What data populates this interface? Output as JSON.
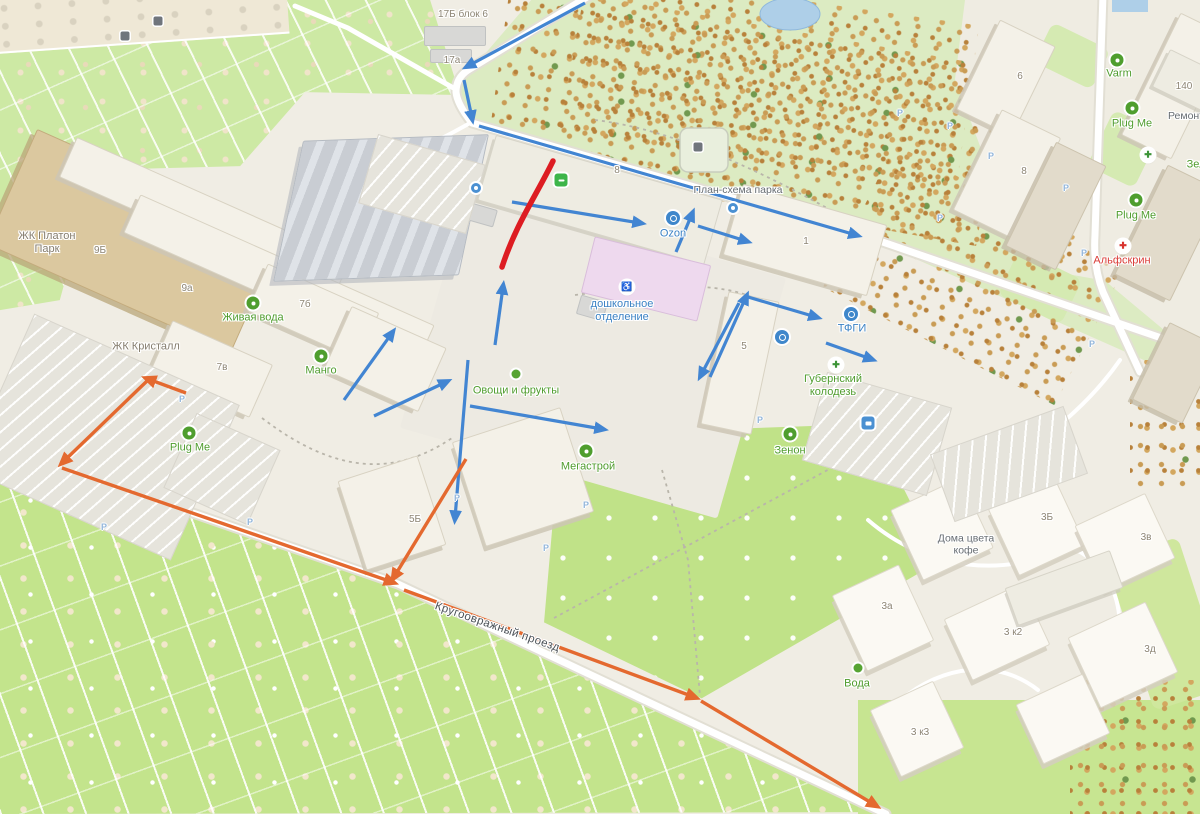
{
  "map": {
    "colors": {
      "route_blue": "#4285d2",
      "route_orange": "#e4692f",
      "closed_red": "#dd1c22",
      "road_casing": "#e2dfd4",
      "road_fill": "#ffffff"
    },
    "labels": [
      {
        "id": "zhk-platon-park",
        "text": "ЖК Платон\nПарк",
        "x": 47,
        "y": 243,
        "cls": "l-dist"
      },
      {
        "id": "zhk-kristall",
        "text": "ЖК Кристалл",
        "x": 146,
        "y": 347,
        "cls": "l-dist"
      },
      {
        "id": "num-9b",
        "text": "9Б",
        "x": 100,
        "y": 251,
        "cls": "l-num"
      },
      {
        "id": "num-9a",
        "text": "9а",
        "x": 187,
        "y": 289,
        "cls": "l-num"
      },
      {
        "id": "num-7b",
        "text": "7б",
        "x": 305,
        "y": 305,
        "cls": "l-num"
      },
      {
        "id": "num-7v",
        "text": "7в",
        "x": 222,
        "y": 368,
        "cls": "l-num"
      },
      {
        "id": "num-5b",
        "text": "5Б",
        "x": 415,
        "y": 520,
        "cls": "l-num"
      },
      {
        "id": "num-5",
        "text": "5",
        "x": 744,
        "y": 347,
        "cls": "l-num"
      },
      {
        "id": "num-1",
        "text": "1",
        "x": 806,
        "y": 242,
        "cls": "l-num"
      },
      {
        "id": "num-6",
        "text": "6",
        "x": 1020,
        "y": 77,
        "cls": "l-num"
      },
      {
        "id": "num-8",
        "text": "8",
        "x": 1024,
        "y": 172,
        "cls": "l-num"
      },
      {
        "id": "num-140",
        "text": "140",
        "x": 1184,
        "y": 87,
        "cls": "l-num"
      },
      {
        "id": "num-3b",
        "text": "3Б",
        "x": 1047,
        "y": 518,
        "cls": "l-num"
      },
      {
        "id": "num-3v",
        "text": "3в",
        "x": 1146,
        "y": 538,
        "cls": "l-num"
      },
      {
        "id": "num-3a",
        "text": "3а",
        "x": 887,
        "y": 607,
        "cls": "l-num"
      },
      {
        "id": "num-3k2",
        "text": "3 к2",
        "x": 1013,
        "y": 633,
        "cls": "l-num"
      },
      {
        "id": "num-3d",
        "text": "3д",
        "x": 1150,
        "y": 650,
        "cls": "l-num"
      },
      {
        "id": "num-3k3",
        "text": "3 к3",
        "x": 920,
        "y": 733,
        "cls": "l-num"
      },
      {
        "id": "num-17b-blok6",
        "text": "17Б блок 6",
        "x": 463,
        "y": 15,
        "cls": "l-num"
      },
      {
        "id": "num-17a",
        "text": "17а",
        "x": 452,
        "y": 61,
        "cls": "l-num"
      },
      {
        "id": "road-num-8",
        "text": "8",
        "x": 617,
        "y": 171,
        "cls": "l-num"
      },
      {
        "id": "poi-zhivaya-voda",
        "text": "Живая вода",
        "x": 253,
        "y": 318,
        "cls": "l-green"
      },
      {
        "id": "poi-mango",
        "text": "Манго",
        "x": 321,
        "y": 371,
        "cls": "l-green"
      },
      {
        "id": "poi-ovoshchi-frukty",
        "text": "Овощи и фрукты",
        "x": 516,
        "y": 391,
        "cls": "l-green"
      },
      {
        "id": "poi-megastroy",
        "text": "Мегастрой",
        "x": 588,
        "y": 467,
        "cls": "l-green"
      },
      {
        "id": "poi-plug-me-left",
        "text": "Plug Me",
        "x": 190,
        "y": 448,
        "cls": "l-green"
      },
      {
        "id": "poi-plug-me-right-upper",
        "text": "Plug Me",
        "x": 1132,
        "y": 124,
        "cls": "l-green"
      },
      {
        "id": "poi-plug-me-right-lower",
        "text": "Plug Me",
        "x": 1136,
        "y": 216,
        "cls": "l-green"
      },
      {
        "id": "poi-varm",
        "text": "Varm",
        "x": 1119,
        "y": 74,
        "cls": "l-green"
      },
      {
        "id": "poi-zenon",
        "text": "Зенон",
        "x": 790,
        "y": 451,
        "cls": "l-green"
      },
      {
        "id": "poi-voda",
        "text": "Вода",
        "x": 857,
        "y": 684,
        "cls": "l-green"
      },
      {
        "id": "poi-zel",
        "text": "Зел",
        "x": 1196,
        "y": 165,
        "cls": "l-green"
      },
      {
        "id": "poi-gubernsky-kolodez",
        "text": "Губернский\nколодезь",
        "x": 833,
        "y": 386,
        "cls": "l-green"
      },
      {
        "id": "poi-ozon",
        "text": "Ozon",
        "x": 673,
        "y": 234,
        "cls": "l-blue"
      },
      {
        "id": "poi-tfgi",
        "text": "ТФГИ",
        "x": 852,
        "y": 329,
        "cls": "l-blue"
      },
      {
        "id": "poi-doshkolnoe",
        "text": "дошкольное\nотделение",
        "x": 622,
        "y": 311,
        "cls": "l-blue"
      },
      {
        "id": "poi-plan-schema-parka",
        "text": "План-схема парка",
        "x": 738,
        "y": 190,
        "cls": "l-gray"
      },
      {
        "id": "poi-doma-tsveta-kofe",
        "text": "Дома цвета\nкофе",
        "x": 966,
        "y": 545,
        "cls": "l-gray"
      },
      {
        "id": "poi-remont",
        "text": "Ремонт",
        "x": 1186,
        "y": 116,
        "cls": "l-gray"
      },
      {
        "id": "poi-alfskrin",
        "text": "Альфскрин",
        "x": 1122,
        "y": 261,
        "cls": "l-red"
      },
      {
        "id": "street-krugoovrazhny",
        "text": "Кругоовражный проезд",
        "x": 497,
        "y": 628,
        "cls": "l-street",
        "rot": 19
      }
    ],
    "icons": [
      {
        "id": "pyaterochka-icon",
        "kind": "green-square",
        "x": 561,
        "y": 180
      },
      {
        "id": "zhivaya-voda-icon",
        "kind": "green-circle",
        "x": 253,
        "y": 303
      },
      {
        "id": "mango-icon",
        "kind": "green-circle",
        "x": 321,
        "y": 356
      },
      {
        "id": "ovoshchi-frukty-icon",
        "kind": "green-dot",
        "x": 516,
        "y": 374
      },
      {
        "id": "megastroy-icon",
        "kind": "green-circle",
        "x": 586,
        "y": 451
      },
      {
        "id": "plug-me-left-icon",
        "kind": "green-circle",
        "x": 189,
        "y": 433
      },
      {
        "id": "plug-me-right-upper-icon",
        "kind": "green-circle",
        "x": 1132,
        "y": 108
      },
      {
        "id": "plug-me-right-lower-icon",
        "kind": "green-circle",
        "x": 1136,
        "y": 200
      },
      {
        "id": "varm-icon",
        "kind": "green-circle",
        "x": 1117,
        "y": 60
      },
      {
        "id": "zenon-icon",
        "kind": "green-circle",
        "x": 790,
        "y": 434
      },
      {
        "id": "voda-icon",
        "kind": "green-dot",
        "x": 858,
        "y": 668
      },
      {
        "id": "gubernsky-kolodez-icon",
        "kind": "green-cross",
        "x": 836,
        "y": 365,
        "g": "✚"
      },
      {
        "id": "pharmacy-cross-icon",
        "kind": "green-cross",
        "x": 1148,
        "y": 155,
        "g": "✚"
      },
      {
        "id": "ozon-icon",
        "kind": "blue-circle",
        "x": 673,
        "y": 218
      },
      {
        "id": "tfgi-icon",
        "kind": "blue-circle",
        "x": 851,
        "y": 314
      },
      {
        "id": "info-icon",
        "kind": "blue-circle",
        "x": 782,
        "y": 337
      },
      {
        "id": "kiosk-icon",
        "kind": "blue-square",
        "x": 868,
        "y": 423
      },
      {
        "id": "alfskrin-icon",
        "kind": "red-circle",
        "x": 1123,
        "y": 246,
        "g": "✚"
      },
      {
        "id": "wheelchair-icon",
        "kind": "wheel",
        "x": 627,
        "y": 287,
        "g": "♿"
      },
      {
        "id": "dog-park-icon",
        "kind": "dark",
        "x": 698,
        "y": 147
      },
      {
        "id": "container-icon",
        "kind": "dark",
        "x": 125,
        "y": 36
      },
      {
        "id": "container2-icon",
        "kind": "dark",
        "x": 158,
        "y": 21
      },
      {
        "id": "stop-dot-icon",
        "kind": "blue-dot",
        "x": 476,
        "y": 188
      },
      {
        "id": "road-dot-icon",
        "kind": "blue-dot",
        "x": 733,
        "y": 208
      }
    ],
    "parking_marks": [
      [
        182,
        399
      ],
      [
        104,
        527
      ],
      [
        250,
        522
      ],
      [
        457,
        498
      ],
      [
        546,
        548
      ],
      [
        950,
        126
      ],
      [
        991,
        156
      ],
      [
        1066,
        188
      ],
      [
        940,
        218
      ],
      [
        1084,
        253
      ],
      [
        900,
        113
      ],
      [
        1092,
        344
      ],
      [
        760,
        420
      ],
      [
        586,
        505
      ]
    ],
    "parking_mark_glyph": "P",
    "buildings": [
      {
        "id": "platon",
        "x": 0,
        "y": 178,
        "w": 268,
        "h": 126,
        "rot": 24,
        "k": "tan"
      },
      {
        "id": "9b",
        "x": 55,
        "y": 196,
        "w": 300,
        "h": 44,
        "rot": 24,
        "k": "std"
      },
      {
        "id": "9a",
        "x": 118,
        "y": 258,
        "w": 322,
        "h": 42,
        "rot": 24,
        "k": "std"
      },
      {
        "id": "7b",
        "x": 252,
        "y": 286,
        "w": 122,
        "h": 52,
        "rot": 24,
        "k": "std"
      },
      {
        "id": "7v",
        "x": 156,
        "y": 340,
        "w": 110,
        "h": 58,
        "rot": 24,
        "k": "std"
      },
      {
        "id": "mango-house",
        "x": 333,
        "y": 324,
        "w": 104,
        "h": 70,
        "rot": 24,
        "k": "std"
      },
      {
        "id": "industrial",
        "x": 288,
        "y": 138,
        "w": 186,
        "h": 140,
        "rot": -2,
        "k": "ind"
      },
      {
        "id": "pyaterochka-bld",
        "x": 482,
        "y": 166,
        "w": 236,
        "h": 68,
        "rot": 16,
        "k": "pale"
      },
      {
        "id": "doshkolnoe-bld",
        "x": 586,
        "y": 250,
        "w": 120,
        "h": 58,
        "rot": 14,
        "k": "pink"
      },
      {
        "id": "1",
        "x": 730,
        "y": 203,
        "w": 150,
        "h": 74,
        "rot": 16,
        "k": "std"
      },
      {
        "id": "5",
        "x": 714,
        "y": 295,
        "w": 52,
        "h": 136,
        "rot": 12,
        "k": "std"
      },
      {
        "id": "6",
        "x": 975,
        "y": 28,
        "w": 62,
        "h": 100,
        "rot": 26,
        "k": "std"
      },
      {
        "id": "8",
        "x": 974,
        "y": 118,
        "w": 66,
        "h": 112,
        "rot": 26,
        "k": "std"
      },
      {
        "id": "right-1",
        "x": 1148,
        "y": 18,
        "w": 56,
        "h": 136,
        "rot": 26,
        "k": "std"
      },
      {
        "id": "right-2",
        "x": 1028,
        "y": 148,
        "w": 56,
        "h": 116,
        "rot": 26,
        "k": "greige"
      },
      {
        "id": "right-3",
        "x": 1138,
        "y": 172,
        "w": 62,
        "h": 122,
        "rot": 26,
        "k": "greige"
      },
      {
        "id": "right-4",
        "x": 1148,
        "y": 330,
        "w": 56,
        "h": 86,
        "rot": 26,
        "k": "greige"
      },
      {
        "id": "140",
        "x": 1158,
        "y": 60,
        "w": 60,
        "h": 42,
        "rot": 26,
        "k": "pale"
      },
      {
        "id": "megastroy-bld",
        "x": 466,
        "y": 422,
        "w": 114,
        "h": 110,
        "rot": -18,
        "k": "std"
      },
      {
        "id": "5b",
        "x": 350,
        "y": 466,
        "w": 84,
        "h": 94,
        "rot": -18,
        "k": "std"
      },
      {
        "id": "kofe-1",
        "x": 903,
        "y": 490,
        "w": 78,
        "h": 78,
        "rot": -25,
        "k": "house"
      },
      {
        "id": "3b",
        "x": 1000,
        "y": 490,
        "w": 74,
        "h": 74,
        "rot": -25,
        "k": "house"
      },
      {
        "id": "3v",
        "x": 1086,
        "y": 506,
        "w": 78,
        "h": 72,
        "rot": -25,
        "k": "house"
      },
      {
        "id": "3a",
        "x": 846,
        "y": 576,
        "w": 74,
        "h": 84,
        "rot": -25,
        "k": "house"
      },
      {
        "id": "3k2",
        "x": 954,
        "y": 598,
        "w": 86,
        "h": 68,
        "rot": -25,
        "k": "house"
      },
      {
        "id": "3d",
        "x": 1080,
        "y": 616,
        "w": 86,
        "h": 78,
        "rot": -25,
        "k": "house"
      },
      {
        "id": "3k3",
        "x": 882,
        "y": 692,
        "w": 70,
        "h": 74,
        "rot": -25,
        "k": "house"
      },
      {
        "id": "kofe-2",
        "x": 1026,
        "y": 686,
        "w": 74,
        "h": 66,
        "rot": -25,
        "k": "house"
      },
      {
        "id": "slab",
        "x": 1008,
        "y": 568,
        "w": 112,
        "h": 40,
        "rot": -20,
        "k": "pale"
      },
      {
        "id": "17b-1",
        "x": 424,
        "y": 26,
        "w": 62,
        "h": 20,
        "rot": 0,
        "k": "gray"
      },
      {
        "id": "17b-2",
        "x": 430,
        "y": 49,
        "w": 42,
        "h": 14,
        "rot": 0,
        "k": "gray"
      },
      {
        "id": "plug-me-bld",
        "x": 100,
        "y": 386,
        "w": 78,
        "h": 48,
        "rot": 24,
        "k": "greenb"
      },
      {
        "id": "shed-1",
        "x": 388,
        "y": 158,
        "w": 38,
        "h": 24,
        "rot": 16,
        "k": "gray"
      },
      {
        "id": "shed-2",
        "x": 432,
        "y": 180,
        "w": 32,
        "h": 20,
        "rot": 16,
        "k": "gray"
      },
      {
        "id": "shed-3",
        "x": 468,
        "y": 206,
        "w": 28,
        "h": 18,
        "rot": 16,
        "k": "gray"
      },
      {
        "id": "shed-4",
        "x": 578,
        "y": 298,
        "w": 28,
        "h": 20,
        "rot": 16,
        "k": "gray"
      }
    ],
    "parking_lots": [
      {
        "id": "pk-left",
        "x": -10,
        "y": 352,
        "w": 225,
        "h": 170,
        "rot": 24
      },
      {
        "id": "pk-mid",
        "x": 176,
        "y": 428,
        "w": 92,
        "h": 82,
        "rot": 24
      },
      {
        "id": "pk-pyaterochka",
        "x": 366,
        "y": 148,
        "w": 112,
        "h": 72,
        "rot": 16
      },
      {
        "id": "pk-zenon",
        "x": 812,
        "y": 388,
        "w": 130,
        "h": 92,
        "rot": 16
      },
      {
        "id": "pk-kofe",
        "x": 938,
        "y": 428,
        "w": 142,
        "h": 72,
        "rot": -20
      }
    ],
    "arrows": {
      "blue": [
        [
          585,
          3,
          468,
          66
        ],
        [
          464,
          80,
          472,
          118
        ],
        [
          479,
          126,
          856,
          235
        ],
        [
          512,
          202,
          640,
          223
        ],
        [
          676,
          252,
          692,
          214
        ],
        [
          698,
          226,
          746,
          241
        ],
        [
          748,
          297,
          816,
          317
        ],
        [
          826,
          343,
          871,
          359
        ],
        [
          710,
          377,
          746,
          297
        ],
        [
          739,
          303,
          701,
          375
        ],
        [
          495,
          345,
          503,
          287
        ],
        [
          468,
          360,
          455,
          518
        ],
        [
          344,
          400,
          392,
          333
        ],
        [
          374,
          416,
          446,
          382
        ],
        [
          470,
          406,
          602,
          429
        ]
      ],
      "orange": [
        [
          186,
          393,
          148,
          379
        ],
        [
          147,
          381,
          63,
          462
        ],
        [
          62,
          468,
          392,
          582
        ],
        [
          466,
          459,
          394,
          577
        ],
        [
          404,
          590,
          694,
          697
        ],
        [
          701,
          701,
          875,
          805
        ]
      ],
      "red_path": "M 553 161 C 536 196 516 224 502 267"
    }
  }
}
